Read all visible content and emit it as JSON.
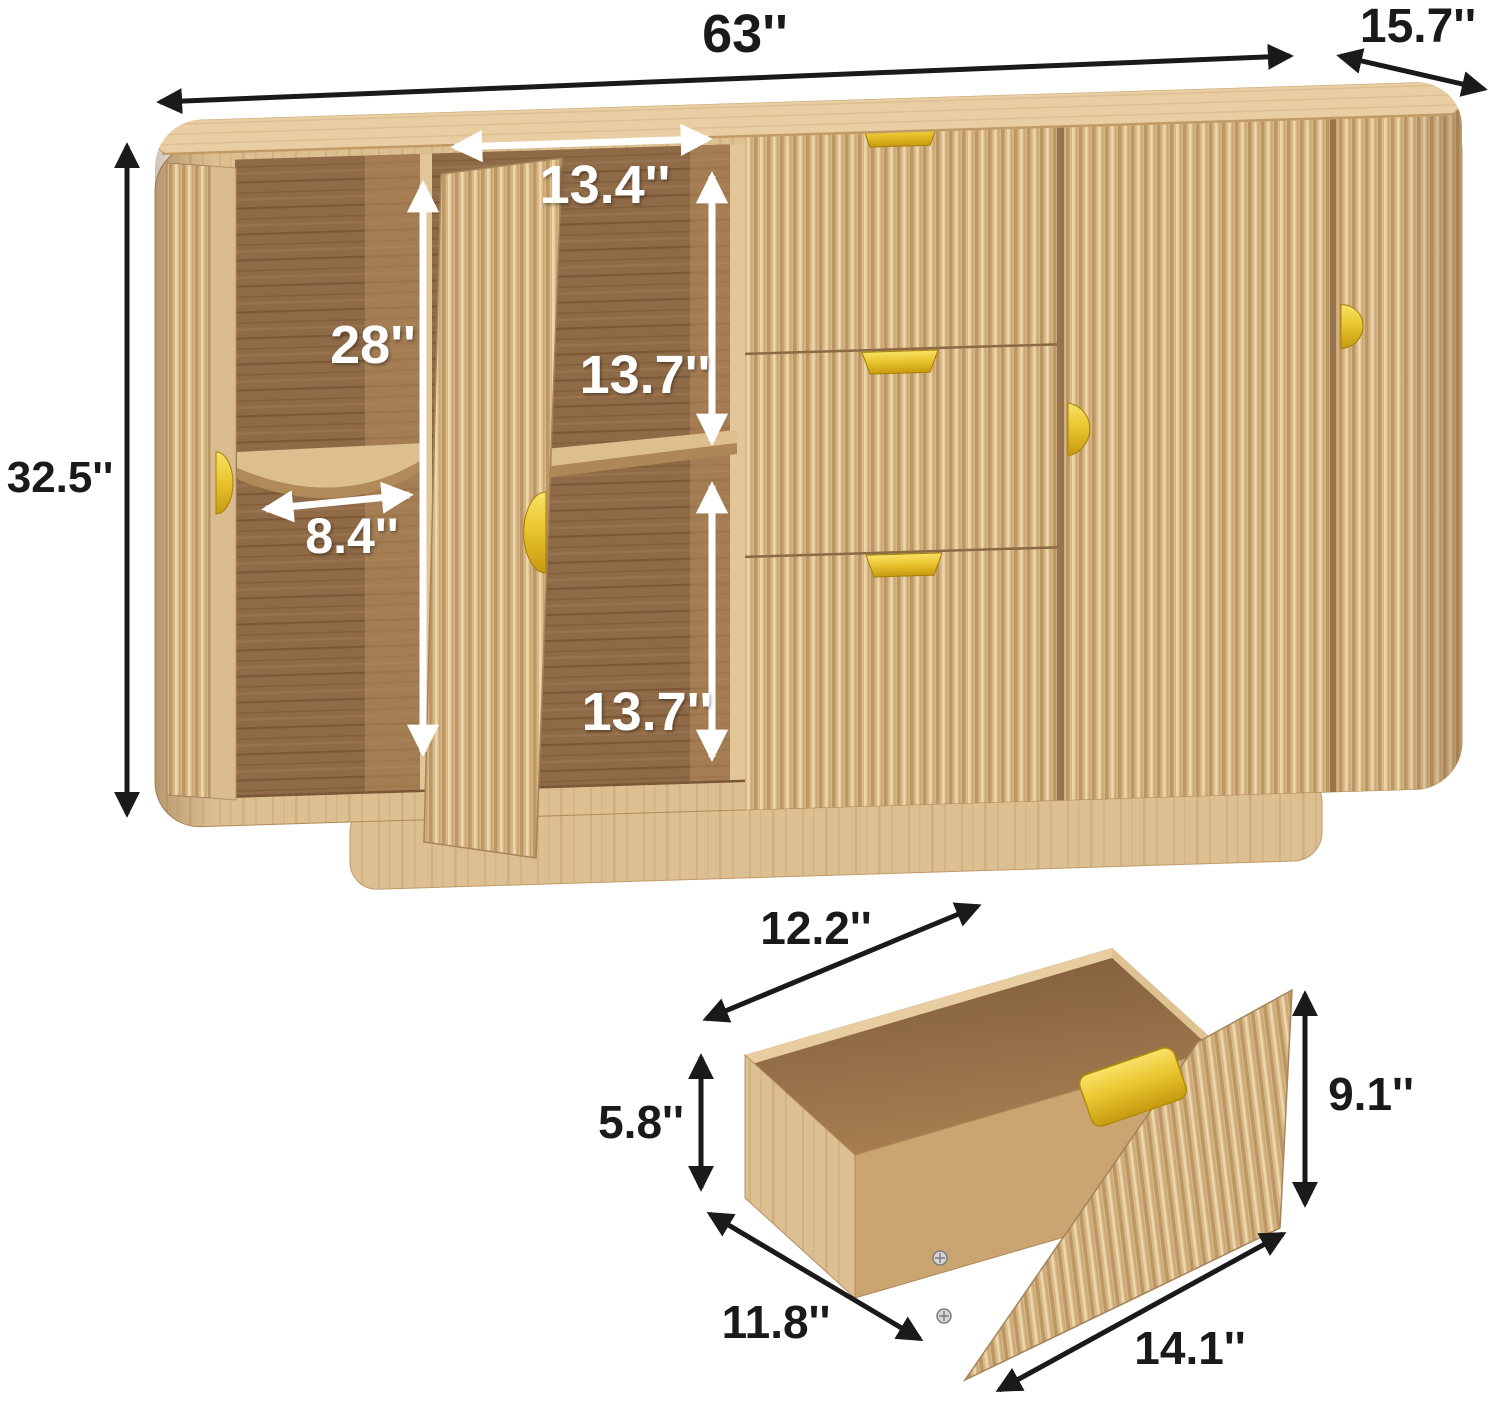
{
  "diagram": {
    "type": "product-dimension-diagram",
    "product": "fluted wood sideboard cabinet with drawer detail",
    "unit": "inches",
    "colors": {
      "wood_light": "#ddc092",
      "wood_top": "#e8cea2",
      "wood_interior": "#8f6a46",
      "gold_accent": "#eac630",
      "arrow_black": "#1a1a1a",
      "arrow_white": "#ffffff",
      "background": "#ffffff"
    },
    "cabinet": {
      "width": "63''",
      "depth": "15.7''",
      "height": "32.5''",
      "top_section_width": "13.4''",
      "interior_height": "28''",
      "upper_compartment_height": "13.7''",
      "lower_compartment_height": "13.7''",
      "corner_shelf_width": "8.4''"
    },
    "drawer": {
      "inner_width": "12.2''",
      "inner_height": "5.8''",
      "inner_depth": "11.8''",
      "front_width": "14.1''",
      "front_height": "9.1''"
    }
  }
}
